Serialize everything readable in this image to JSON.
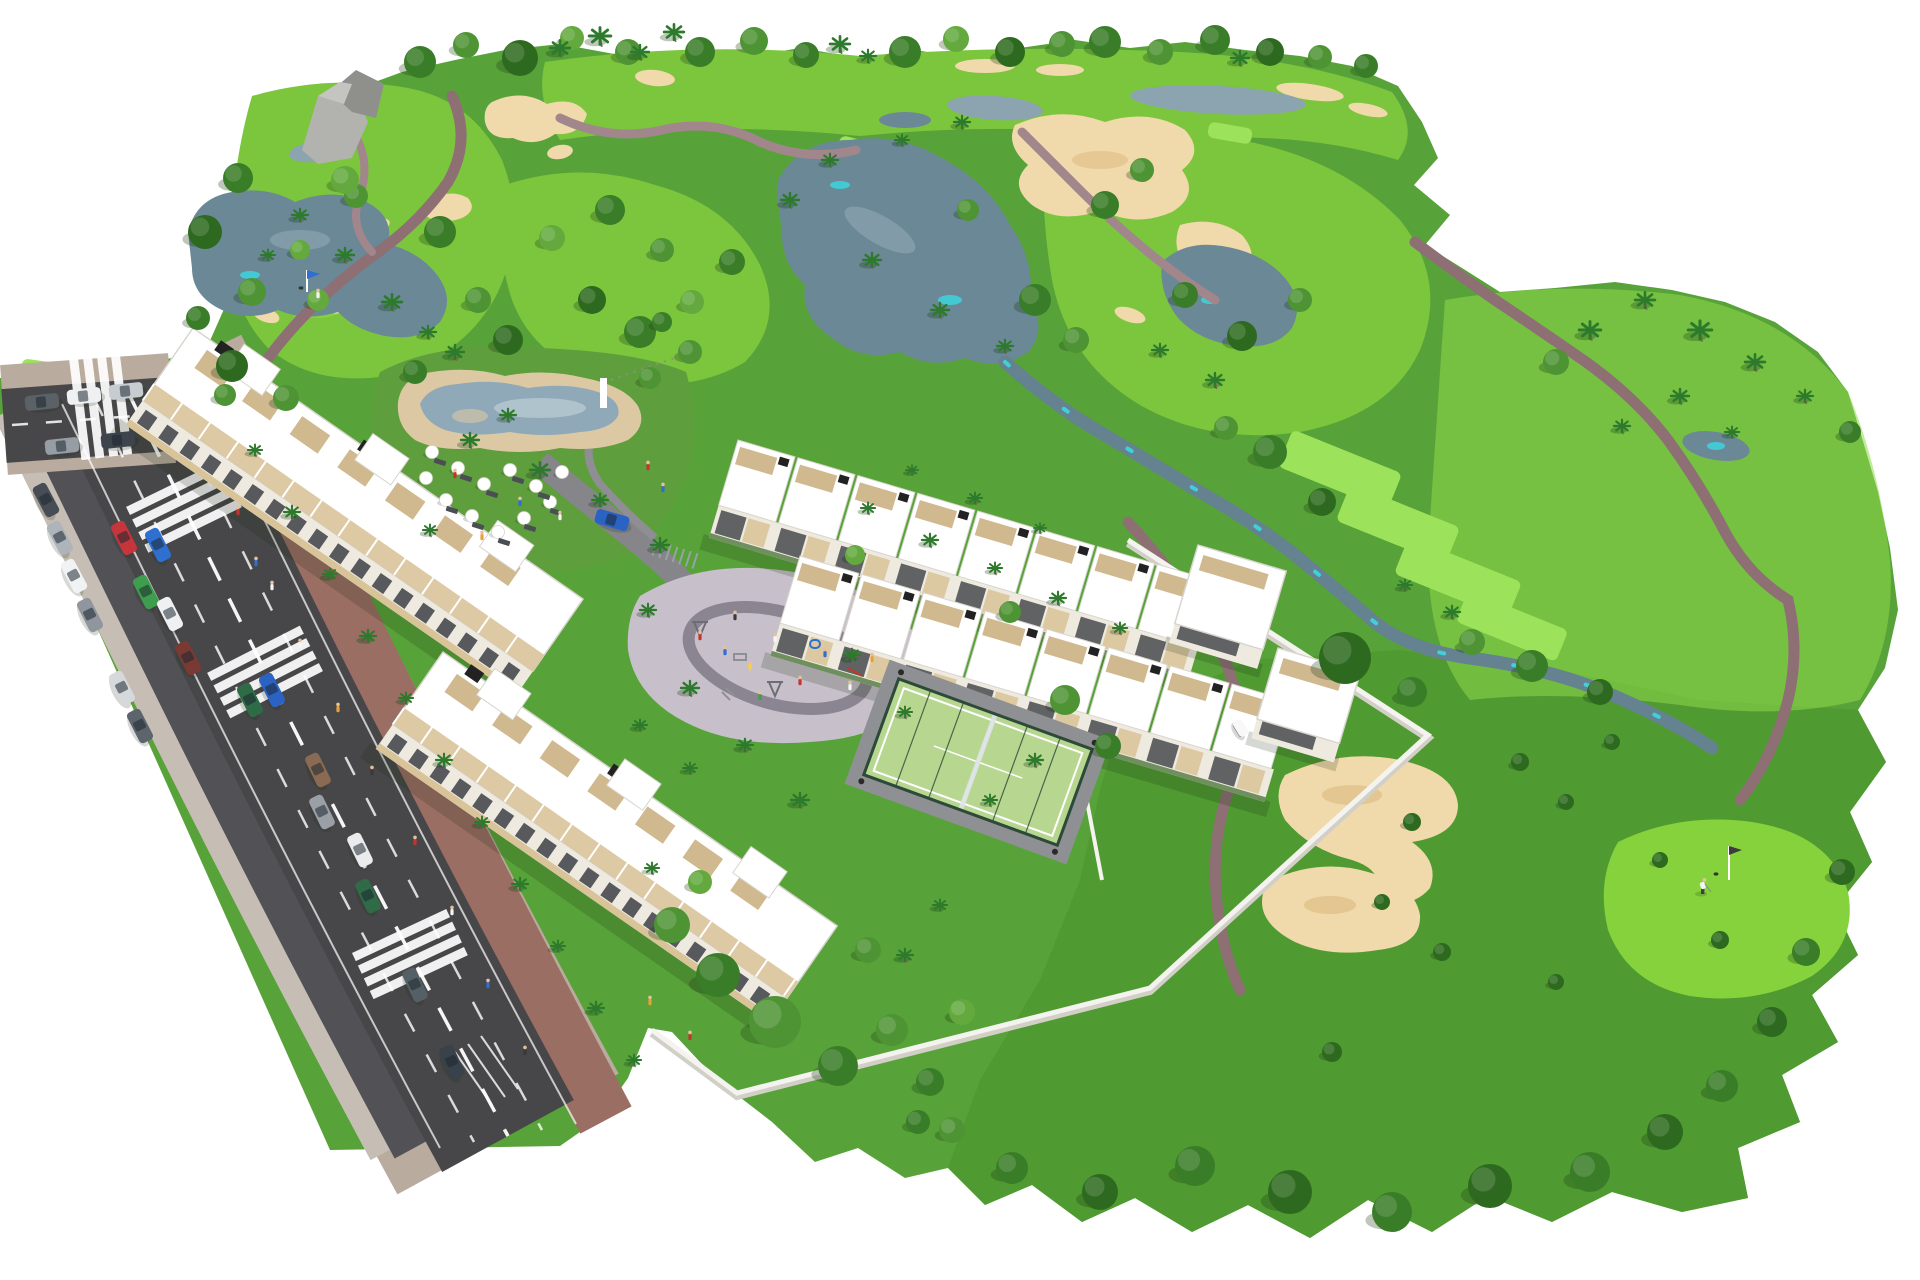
{
  "meta": {
    "description": "Aerial 3D architectural rendering of a white low-rise residential resort complex with pool, playground and padel court, set beside a golf course with lakes, sand bunkers, winding cart paths, palm trees and a road with parked cars. No text is visible in the image.",
    "visible_text": []
  },
  "colors": {
    "background": "#ffffff",
    "terrain": "#58a339",
    "terrain_light": "#69b542",
    "fairway": "#7cc63e",
    "fairway_bright": "#8fd84b",
    "tee": "#9ce25a",
    "rough_dark": "#4f9a31",
    "green_putting": "#86d23c",
    "lake": "#6b8896",
    "lake_light": "#8ba4b0",
    "lake_teal": "#3fd0da",
    "creek": "#64828f",
    "bunker": "#f0d9ab",
    "bunker_shade": "#ddbd85",
    "path": "#8d6f74",
    "path_light": "#a1868c",
    "road": "#474749",
    "parking_lane": "#515156",
    "marking": "#ffffff",
    "sidewalk": "#b9ab9e",
    "outer_walk": "#c6beb4",
    "paver": "#9a6e63",
    "wall": "#f4f3ef",
    "wall_shade": "#d2cfc7",
    "building": "#ffffff",
    "building_edge": "#d8d5ce",
    "facade": "#efeae0",
    "window": "#3c4045",
    "balcony": "#d9c49a",
    "pergola": "#cdb489",
    "roof_box": "#222222",
    "planter": "#6f8f5f",
    "pool_deck": "#dcc9a4",
    "pool_water": "#8fa9b8",
    "pool_water_light": "#b6c9d2",
    "lawn": "#5f9e3c",
    "plaza": "#c7c0ca",
    "plaza_ring": "#8b8591",
    "court": "#b7d690",
    "court_fence": "#2c4a37",
    "rock": "#b2b2ae",
    "rock_dark": "#8f8f8b",
    "palm": "#2e7a2d",
    "trunk": "#7a6a52",
    "skin": "#e6c09a",
    "shadow": "rgba(20,40,15,0.18)",
    "tree_shadow": "rgba(25,55,18,0.28)"
  },
  "scene": {
    "tree_shades": [
      "#2d6a1f",
      "#3a7d28",
      "#4e9434",
      "#63a93e",
      "#2f7a45",
      "#79b94a"
    ],
    "trees_round": [
      [
        420,
        62,
        16,
        1
      ],
      [
        466,
        45,
        13,
        2
      ],
      [
        520,
        58,
        18,
        0
      ],
      [
        700,
        52,
        15,
        1
      ],
      [
        754,
        41,
        14,
        2
      ],
      [
        806,
        55,
        13,
        1
      ],
      [
        905,
        52,
        16,
        1
      ],
      [
        956,
        39,
        13,
        3
      ],
      [
        1010,
        52,
        15,
        0
      ],
      [
        1062,
        44,
        13,
        2
      ],
      [
        1105,
        42,
        16,
        1
      ],
      [
        1160,
        52,
        13,
        2
      ],
      [
        1215,
        40,
        15,
        1
      ],
      [
        1270,
        52,
        14,
        0
      ],
      [
        1320,
        57,
        12,
        2
      ],
      [
        1366,
        66,
        12,
        1
      ],
      [
        572,
        38,
        12,
        3
      ],
      [
        628,
        52,
        13,
        2
      ],
      [
        238,
        178,
        15,
        1
      ],
      [
        205,
        232,
        17,
        0
      ],
      [
        252,
        292,
        14,
        2
      ],
      [
        198,
        318,
        12,
        1
      ],
      [
        232,
        366,
        16,
        0
      ],
      [
        286,
        398,
        13,
        2
      ],
      [
        318,
        300,
        11,
        3
      ],
      [
        356,
        196,
        12,
        2
      ],
      [
        300,
        250,
        10,
        3
      ],
      [
        345,
        180,
        14,
        3
      ],
      [
        440,
        232,
        16,
        1
      ],
      [
        478,
        300,
        13,
        2
      ],
      [
        508,
        340,
        15,
        0
      ],
      [
        415,
        372,
        12,
        1
      ],
      [
        552,
        238,
        13,
        3
      ],
      [
        610,
        210,
        15,
        1
      ],
      [
        662,
        250,
        12,
        2
      ],
      [
        592,
        300,
        14,
        0
      ],
      [
        640,
        332,
        16,
        1
      ],
      [
        692,
        302,
        12,
        3
      ],
      [
        732,
        262,
        13,
        1
      ],
      [
        1035,
        300,
        16,
        1
      ],
      [
        1076,
        340,
        13,
        2
      ],
      [
        968,
        210,
        11,
        2
      ],
      [
        1105,
        205,
        14,
        1
      ],
      [
        1142,
        170,
        12,
        2
      ],
      [
        1185,
        295,
        13,
        1
      ],
      [
        1242,
        336,
        15,
        0
      ],
      [
        1300,
        300,
        12,
        2
      ],
      [
        1270,
        452,
        17,
        1
      ],
      [
        1322,
        502,
        14,
        0
      ],
      [
        1345,
        658,
        26,
        0
      ],
      [
        1412,
        692,
        15,
        1
      ],
      [
        1472,
        642,
        13,
        2
      ],
      [
        1532,
        666,
        16,
        1
      ],
      [
        1600,
        692,
        13,
        0
      ],
      [
        1226,
        428,
        12,
        2
      ],
      [
        1556,
        362,
        13,
        2
      ],
      [
        1850,
        432,
        11,
        1
      ],
      [
        1520,
        762,
        9,
        0
      ],
      [
        1566,
        802,
        8,
        0
      ],
      [
        1612,
        742,
        8,
        0
      ],
      [
        1412,
        822,
        9,
        0
      ],
      [
        1382,
        902,
        8,
        0
      ],
      [
        1442,
        952,
        9,
        0
      ],
      [
        1332,
        1052,
        10,
        0
      ],
      [
        1556,
        982,
        8,
        0
      ],
      [
        1660,
        860,
        8,
        0
      ],
      [
        1720,
        940,
        9,
        0
      ],
      [
        1195,
        1166,
        20,
        1
      ],
      [
        1290,
        1192,
        22,
        0
      ],
      [
        1392,
        1212,
        20,
        1
      ],
      [
        1490,
        1186,
        22,
        0
      ],
      [
        1590,
        1172,
        20,
        1
      ],
      [
        1665,
        1132,
        18,
        0
      ],
      [
        1722,
        1086,
        16,
        1
      ],
      [
        1772,
        1022,
        15,
        0
      ],
      [
        1806,
        952,
        14,
        1
      ],
      [
        1842,
        872,
        13,
        0
      ],
      [
        1100,
        1192,
        18,
        0
      ],
      [
        1012,
        1168,
        16,
        1
      ],
      [
        952,
        1130,
        13,
        2
      ],
      [
        225,
        395,
        11,
        2
      ],
      [
        672,
        925,
        18,
        2
      ],
      [
        718,
        975,
        22,
        1
      ],
      [
        775,
        1022,
        26,
        2
      ],
      [
        838,
        1066,
        20,
        1
      ],
      [
        892,
        1030,
        16,
        2
      ],
      [
        930,
        1082,
        14,
        1
      ],
      [
        962,
        1012,
        13,
        3
      ],
      [
        700,
        882,
        12,
        3
      ],
      [
        868,
        950,
        13,
        2
      ],
      [
        918,
        1122,
        12,
        1
      ],
      [
        855,
        555,
        10,
        3
      ],
      [
        1010,
        612,
        11,
        2
      ],
      [
        1065,
        700,
        15,
        2
      ],
      [
        1108,
        746,
        13,
        1
      ],
      [
        690,
        352,
        12,
        2
      ],
      [
        662,
        322,
        10,
        1
      ],
      [
        650,
        378,
        11,
        2
      ]
    ],
    "palms": [
      [
        560,
        48,
        1.1
      ],
      [
        600,
        36,
        1.2
      ],
      [
        640,
        52,
        1.0
      ],
      [
        674,
        32,
        1.1
      ],
      [
        840,
        44,
        1.1
      ],
      [
        868,
        56,
        0.9
      ],
      [
        1240,
        58,
        1.0
      ],
      [
        300,
        215,
        0.9
      ],
      [
        345,
        255,
        1.0
      ],
      [
        392,
        302,
        1.1
      ],
      [
        428,
        332,
        0.9
      ],
      [
        268,
        255,
        0.8
      ],
      [
        455,
        352,
        1.0
      ],
      [
        790,
        200,
        1.0
      ],
      [
        830,
        160,
        0.9
      ],
      [
        872,
        260,
        1.0
      ],
      [
        940,
        310,
        1.0
      ],
      [
        1005,
        346,
        0.9
      ],
      [
        902,
        140,
        0.8
      ],
      [
        962,
        122,
        0.9
      ],
      [
        1160,
        350,
        0.9
      ],
      [
        1215,
        380,
        1.0
      ],
      [
        1590,
        330,
        1.2
      ],
      [
        1645,
        300,
        1.1
      ],
      [
        1700,
        330,
        1.3
      ],
      [
        1755,
        362,
        1.1
      ],
      [
        1805,
        396,
        0.9
      ],
      [
        1680,
        396,
        1.0
      ],
      [
        1622,
        426,
        0.9
      ],
      [
        1732,
        432,
        0.8
      ],
      [
        255,
        450,
        0.8
      ],
      [
        292,
        512,
        0.9
      ],
      [
        330,
        574,
        0.8
      ],
      [
        368,
        636,
        0.9
      ],
      [
        406,
        698,
        0.8
      ],
      [
        444,
        760,
        0.9
      ],
      [
        482,
        822,
        0.8
      ],
      [
        520,
        884,
        0.9
      ],
      [
        558,
        946,
        0.8
      ],
      [
        596,
        1008,
        0.9
      ],
      [
        634,
        1060,
        0.8
      ],
      [
        905,
        955,
        0.9
      ],
      [
        940,
        905,
        0.8
      ],
      [
        652,
        868,
        0.8
      ],
      [
        868,
        508,
        0.8
      ],
      [
        930,
        540,
        0.9
      ],
      [
        995,
        568,
        0.8
      ],
      [
        1058,
        598,
        0.9
      ],
      [
        1120,
        628,
        0.8
      ],
      [
        912,
        470,
        0.7
      ],
      [
        975,
        498,
        0.8
      ],
      [
        1040,
        528,
        0.7
      ],
      [
        470,
        440,
        1.0
      ],
      [
        540,
        470,
        1.1
      ],
      [
        600,
        500,
        0.9
      ],
      [
        430,
        530,
        0.8
      ],
      [
        508,
        415,
        0.9
      ],
      [
        660,
        545,
        1.0
      ],
      [
        648,
        610,
        0.9
      ],
      [
        690,
        688,
        1.0
      ],
      [
        745,
        745,
        0.9
      ],
      [
        800,
        800,
        1.0
      ],
      [
        852,
        655,
        0.9
      ],
      [
        905,
        712,
        0.8
      ],
      [
        690,
        768,
        0.8
      ],
      [
        640,
        725,
        0.8
      ],
      [
        1035,
        760,
        0.9
      ],
      [
        990,
        800,
        0.8
      ],
      [
        1452,
        612,
        0.9
      ],
      [
        1405,
        585,
        0.8
      ]
    ],
    "tee_boxes": [
      [
        1340,
        470,
        118,
        40,
        22
      ],
      [
        1398,
        524,
        118,
        40,
        22
      ],
      [
        1458,
        578,
        122,
        40,
        22
      ],
      [
        1512,
        626,
        108,
        34,
        22
      ],
      [
        48,
        372,
        54,
        20,
        8
      ],
      [
        118,
        384,
        58,
        20,
        8
      ],
      [
        345,
        455,
        58,
        24,
        18
      ],
      [
        864,
        150,
        52,
        18,
        14
      ],
      [
        1094,
        162,
        56,
        18,
        14
      ],
      [
        1230,
        133,
        44,
        16,
        10
      ]
    ],
    "road": {
      "crosswalks": [
        [
          182,
          503,
          64
        ],
        [
          263,
          668,
          63
        ],
        [
          408,
          950,
          65
        ],
        [
          96,
          406,
          -7
        ]
      ],
      "cars": [
        [
          42,
          402,
          -6,
          "#5a6167"
        ],
        [
          84,
          396,
          -6,
          "#eef0f2"
        ],
        [
          126,
          391,
          -6,
          "#c7ccd1"
        ],
        [
          62,
          446,
          -6,
          "#969da4"
        ],
        [
          118,
          440,
          -6,
          "#3d444c"
        ],
        [
          46,
          500,
          62,
          "#474d55"
        ],
        [
          60,
          538,
          62,
          "#aeb4ba"
        ],
        [
          74,
          576,
          62,
          "#f0f2f4"
        ],
        [
          90,
          615,
          63,
          "#8f969d"
        ],
        [
          122,
          688,
          63,
          "#d6d9dc"
        ],
        [
          140,
          726,
          63,
          "#5d646b"
        ],
        [
          124,
          538,
          63,
          "#c6343c"
        ],
        [
          158,
          545,
          63,
          "#2f6fd0"
        ],
        [
          146,
          592,
          63,
          "#3f9e4d"
        ],
        [
          170,
          614,
          63,
          "#eef0f2"
        ],
        [
          188,
          658,
          63,
          "#7a3a33"
        ],
        [
          250,
          700,
          63,
          "#2e6b46"
        ],
        [
          322,
          812,
          64,
          "#9aa0a6"
        ],
        [
          368,
          896,
          64,
          "#2e6b46"
        ],
        [
          415,
          985,
          65,
          "#556066"
        ],
        [
          452,
          1062,
          65,
          "#39424b"
        ],
        [
          272,
          690,
          63,
          "#2a63c4"
        ],
        [
          318,
          770,
          64,
          "#8a6a52"
        ],
        [
          360,
          850,
          64,
          "#e9ebed"
        ],
        [
          612,
          520,
          16,
          "#2a63c4"
        ]
      ]
    },
    "buildings": {
      "apartment_blocks": [
        {
          "x": 193,
          "y": 328,
          "angle": 34.8,
          "len": 475,
          "depth": 88,
          "facade": 30
        },
        {
          "x": 443,
          "y": 652,
          "angle": 34.8,
          "len": 480,
          "depth": 88,
          "facade": 30
        }
      ],
      "townhouse_rows": [
        {
          "x": 738,
          "y": 440,
          "angle": 16.5,
          "len": 500,
          "depth": 68,
          "facade": 34,
          "units": 8
        },
        {
          "x": 800,
          "y": 556,
          "angle": 16.5,
          "len": 515,
          "depth": 70,
          "facade": 34,
          "units": 8
        }
      ],
      "end_towers": [
        {
          "x": 1198,
          "y": 545,
          "angle": 16.5,
          "w": 92,
          "h": 96
        },
        {
          "x": 1278,
          "y": 648,
          "angle": 16.5,
          "w": 86,
          "h": 88
        }
      ]
    },
    "pool_furniture": {
      "umbrellas": [
        [
          432,
          452
        ],
        [
          458,
          468
        ],
        [
          484,
          484
        ],
        [
          510,
          470
        ],
        [
          536,
          486
        ],
        [
          446,
          500
        ],
        [
          472,
          516
        ],
        [
          498,
          532
        ],
        [
          524,
          518
        ],
        [
          550,
          502
        ],
        [
          562,
          472
        ],
        [
          426,
          478
        ]
      ],
      "loungers": [
        [
          440,
          462
        ],
        [
          466,
          478
        ],
        [
          492,
          494
        ],
        [
          518,
          480
        ],
        [
          544,
          496
        ],
        [
          452,
          510
        ],
        [
          478,
          526
        ],
        [
          504,
          542
        ],
        [
          530,
          528
        ],
        [
          556,
          512
        ]
      ]
    },
    "bike_racks": {
      "x": 655,
      "y": 548,
      "angle": 18,
      "count": 7
    },
    "people": [
      [
        238,
        515,
        "#c4342f"
      ],
      [
        256,
        566,
        "#2f6fd0"
      ],
      [
        300,
        648,
        "#f5f5f5"
      ],
      [
        338,
        712,
        "#e8a13a"
      ],
      [
        372,
        775,
        "#3a3a3a"
      ],
      [
        415,
        845,
        "#c4342f"
      ],
      [
        452,
        915,
        "#f5f5f5"
      ],
      [
        488,
        988,
        "#2f6fd0"
      ],
      [
        525,
        1055,
        "#3a3a3a"
      ],
      [
        272,
        590,
        "#f5f5f5"
      ],
      [
        650,
        1005,
        "#e8a13a"
      ],
      [
        690,
        1040,
        "#c4342f"
      ],
      [
        700,
        640,
        "#c4342f"
      ],
      [
        725,
        655,
        "#2f6fd0"
      ],
      [
        750,
        670,
        "#f7d13e"
      ],
      [
        775,
        642,
        "#f5f5f5"
      ],
      [
        800,
        685,
        "#c4342f"
      ],
      [
        825,
        657,
        "#2f6fd0"
      ],
      [
        760,
        700,
        "#3f9e4d"
      ],
      [
        850,
        690,
        "#f5f5f5"
      ],
      [
        872,
        662,
        "#e8a13a"
      ],
      [
        735,
        620,
        "#3a3a3a"
      ],
      [
        455,
        478,
        "#c4342f"
      ],
      [
        520,
        506,
        "#2f6fd0"
      ],
      [
        560,
        520,
        "#f5f5f5"
      ],
      [
        482,
        540,
        "#e8a13a"
      ],
      [
        648,
        470,
        "#c4342f"
      ],
      [
        663,
        492,
        "#2f6fd0"
      ],
      [
        318,
        298,
        "#f5f5f5"
      ]
    ],
    "golf": {
      "flags": [
        [
          307,
          292,
          22,
          "#2f6fd0"
        ],
        [
          1729,
          880,
          34,
          "#3c3c3c"
        ]
      ],
      "holes": [
        [
          307,
          292
        ],
        [
          1722,
          878
        ]
      ],
      "golfer": {
        "x": 1703,
        "y": 886
      },
      "cart": {
        "x": 1240,
        "y": 729,
        "angle": 58
      }
    }
  }
}
